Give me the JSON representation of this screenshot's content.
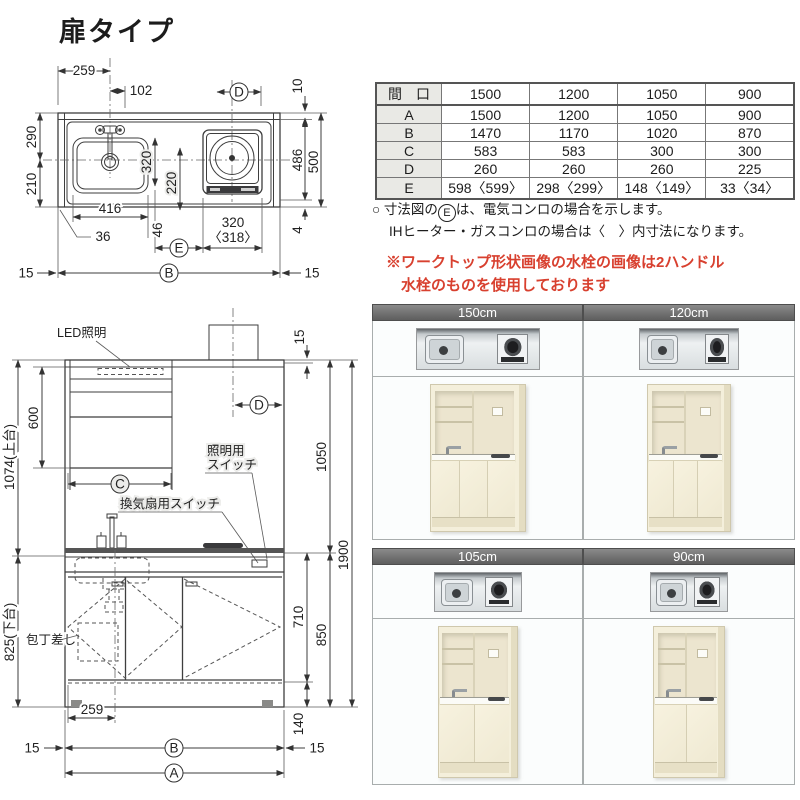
{
  "page": {
    "title": "扉タイプ"
  },
  "colors": {
    "red_note": "#d8402f",
    "grid_header_bg": "#6b6b6b",
    "cabinet_cream": "#f4efdb",
    "drawing_fill": "#ececea",
    "table_label_bg": "#e9e9e5"
  },
  "spec_table": {
    "header": [
      "間　口",
      "1500",
      "1200",
      "1050",
      "900"
    ],
    "rows": [
      {
        "label": "A",
        "values": [
          "1500",
          "1200",
          "1050",
          "900"
        ]
      },
      {
        "label": "B",
        "values": [
          "1470",
          "1170",
          "1020",
          "870"
        ]
      },
      {
        "label": "C",
        "values": [
          "583",
          "583",
          "300",
          "300"
        ]
      },
      {
        "label": "D",
        "values": [
          "260",
          "260",
          "260",
          "225"
        ]
      },
      {
        "label": "E",
        "values": [
          "598〈599〉",
          "298〈299〉",
          "148〈149〉",
          "33〈34〉"
        ]
      }
    ]
  },
  "notes": {
    "line1_prefix": "○ 寸法図の",
    "line1_mark": "E",
    "line1_suffix": "は、電気コンロの場合を示します。",
    "line2": "IHヒーター・ガスコンロの場合は〈　〉内寸法になります。"
  },
  "red_note": {
    "line1": "※ワークトップ形状画像の水栓の画像は2ハンドル",
    "line2": "水栓のものを使用しております"
  },
  "photo_grid": {
    "cells": [
      {
        "label": "150cm"
      },
      {
        "label": "120cm"
      },
      {
        "label": "105cm"
      },
      {
        "label": "90cm"
      }
    ]
  },
  "top_view": {
    "dims": {
      "d259": "259",
      "d102": "102",
      "dD": "D",
      "d10": "10",
      "d290": "290",
      "d210": "210",
      "d320i": "320",
      "d220": "220",
      "d486": "486",
      "d500": "500",
      "d4": "4",
      "d416": "416",
      "d36": "36",
      "d46": "46",
      "dE": "E",
      "d320b": "320",
      "d318": "〈318〉",
      "d15L": "15",
      "dB": "B",
      "d15R": "15"
    }
  },
  "front_view": {
    "callouts": {
      "led": "LED照明",
      "light1": "照明用",
      "light2": "スイッチ",
      "fan": "換気扇用スイッチ",
      "knife": "包丁差し"
    },
    "dims": {
      "d15top": "15",
      "d600": "600",
      "d1074": "1074(上台)",
      "dC": "C",
      "dD": "D",
      "d1050": "1050",
      "d1900": "1900",
      "d710": "710",
      "d850": "850",
      "d825": "825(下台)",
      "d140": "140",
      "d259": "259",
      "d15L": "15",
      "dB": "B",
      "dA": "A",
      "d15R": "15"
    }
  }
}
